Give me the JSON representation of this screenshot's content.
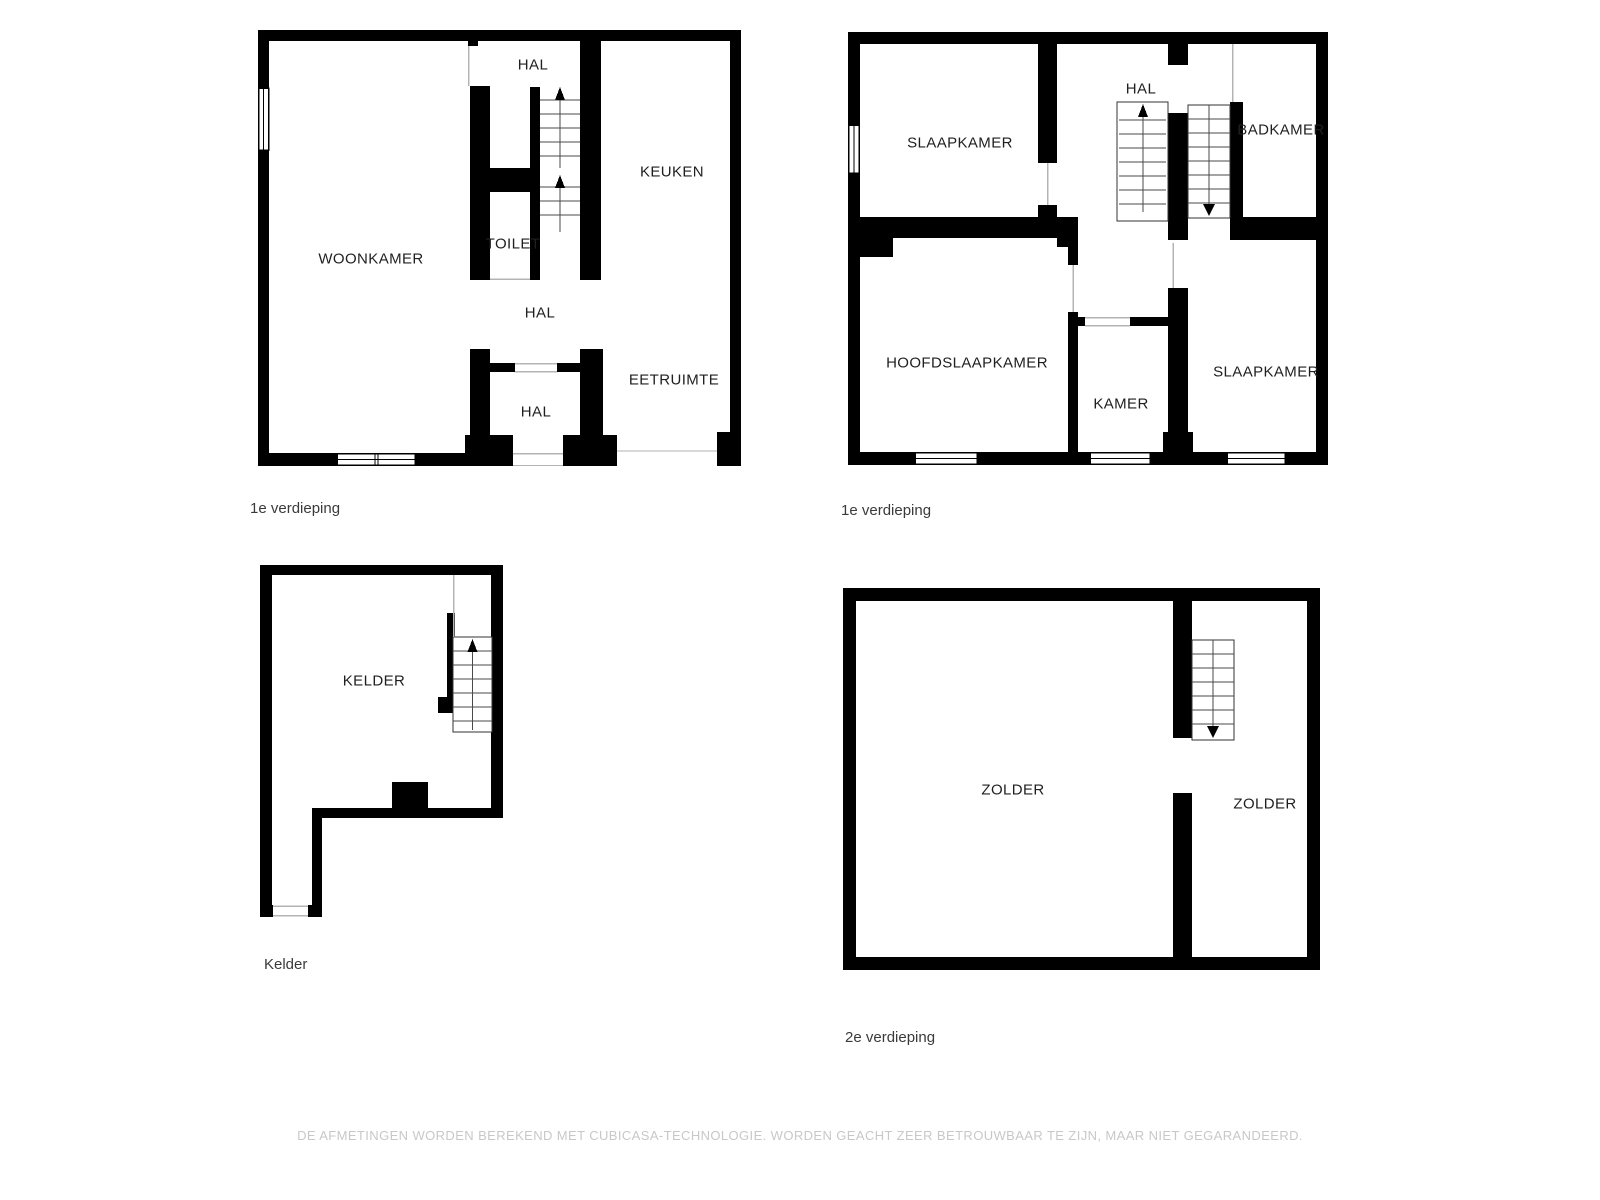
{
  "colors": {
    "wall": "#000000",
    "room_label": "#1f1f1f",
    "floor_label": "#3a3a3a",
    "disclaimer": "#c8c8c8",
    "door_line": "#b4b4b4"
  },
  "plans": {
    "ground_floor": {
      "floor_label": "1e verdieping",
      "rooms": {
        "woonkamer": "WOONKAMER",
        "hal_top": "HAL",
        "keuken": "KEUKEN",
        "toilet": "TOILET",
        "hal_mid": "HAL",
        "hal_entry": "HAL",
        "eetruimte": "EETRUIMTE"
      }
    },
    "first_floor": {
      "floor_label": "1e verdieping",
      "rooms": {
        "slaapkamer_1": "SLAAPKAMER",
        "hal": "HAL",
        "badkamer": "BADKAMER",
        "hoofdslaapkamer": "HOOFDSLAAPKAMER",
        "kamer": "KAMER",
        "slaapkamer_2": "SLAAPKAMER"
      }
    },
    "basement": {
      "floor_label": "Kelder",
      "rooms": {
        "kelder": "KELDER"
      }
    },
    "attic": {
      "floor_label": "2e verdieping",
      "rooms": {
        "zolder_left": "ZOLDER",
        "zolder_right": "ZOLDER"
      }
    }
  },
  "footer": {
    "disclaimer": "DE AFMETINGEN WORDEN BEREKEND MET CUBICASA-TECHNOLOGIE. WORDEN GEACHT ZEER BETROUWBAAR TE ZIJN, MAAR NIET GEGARANDEERD."
  }
}
